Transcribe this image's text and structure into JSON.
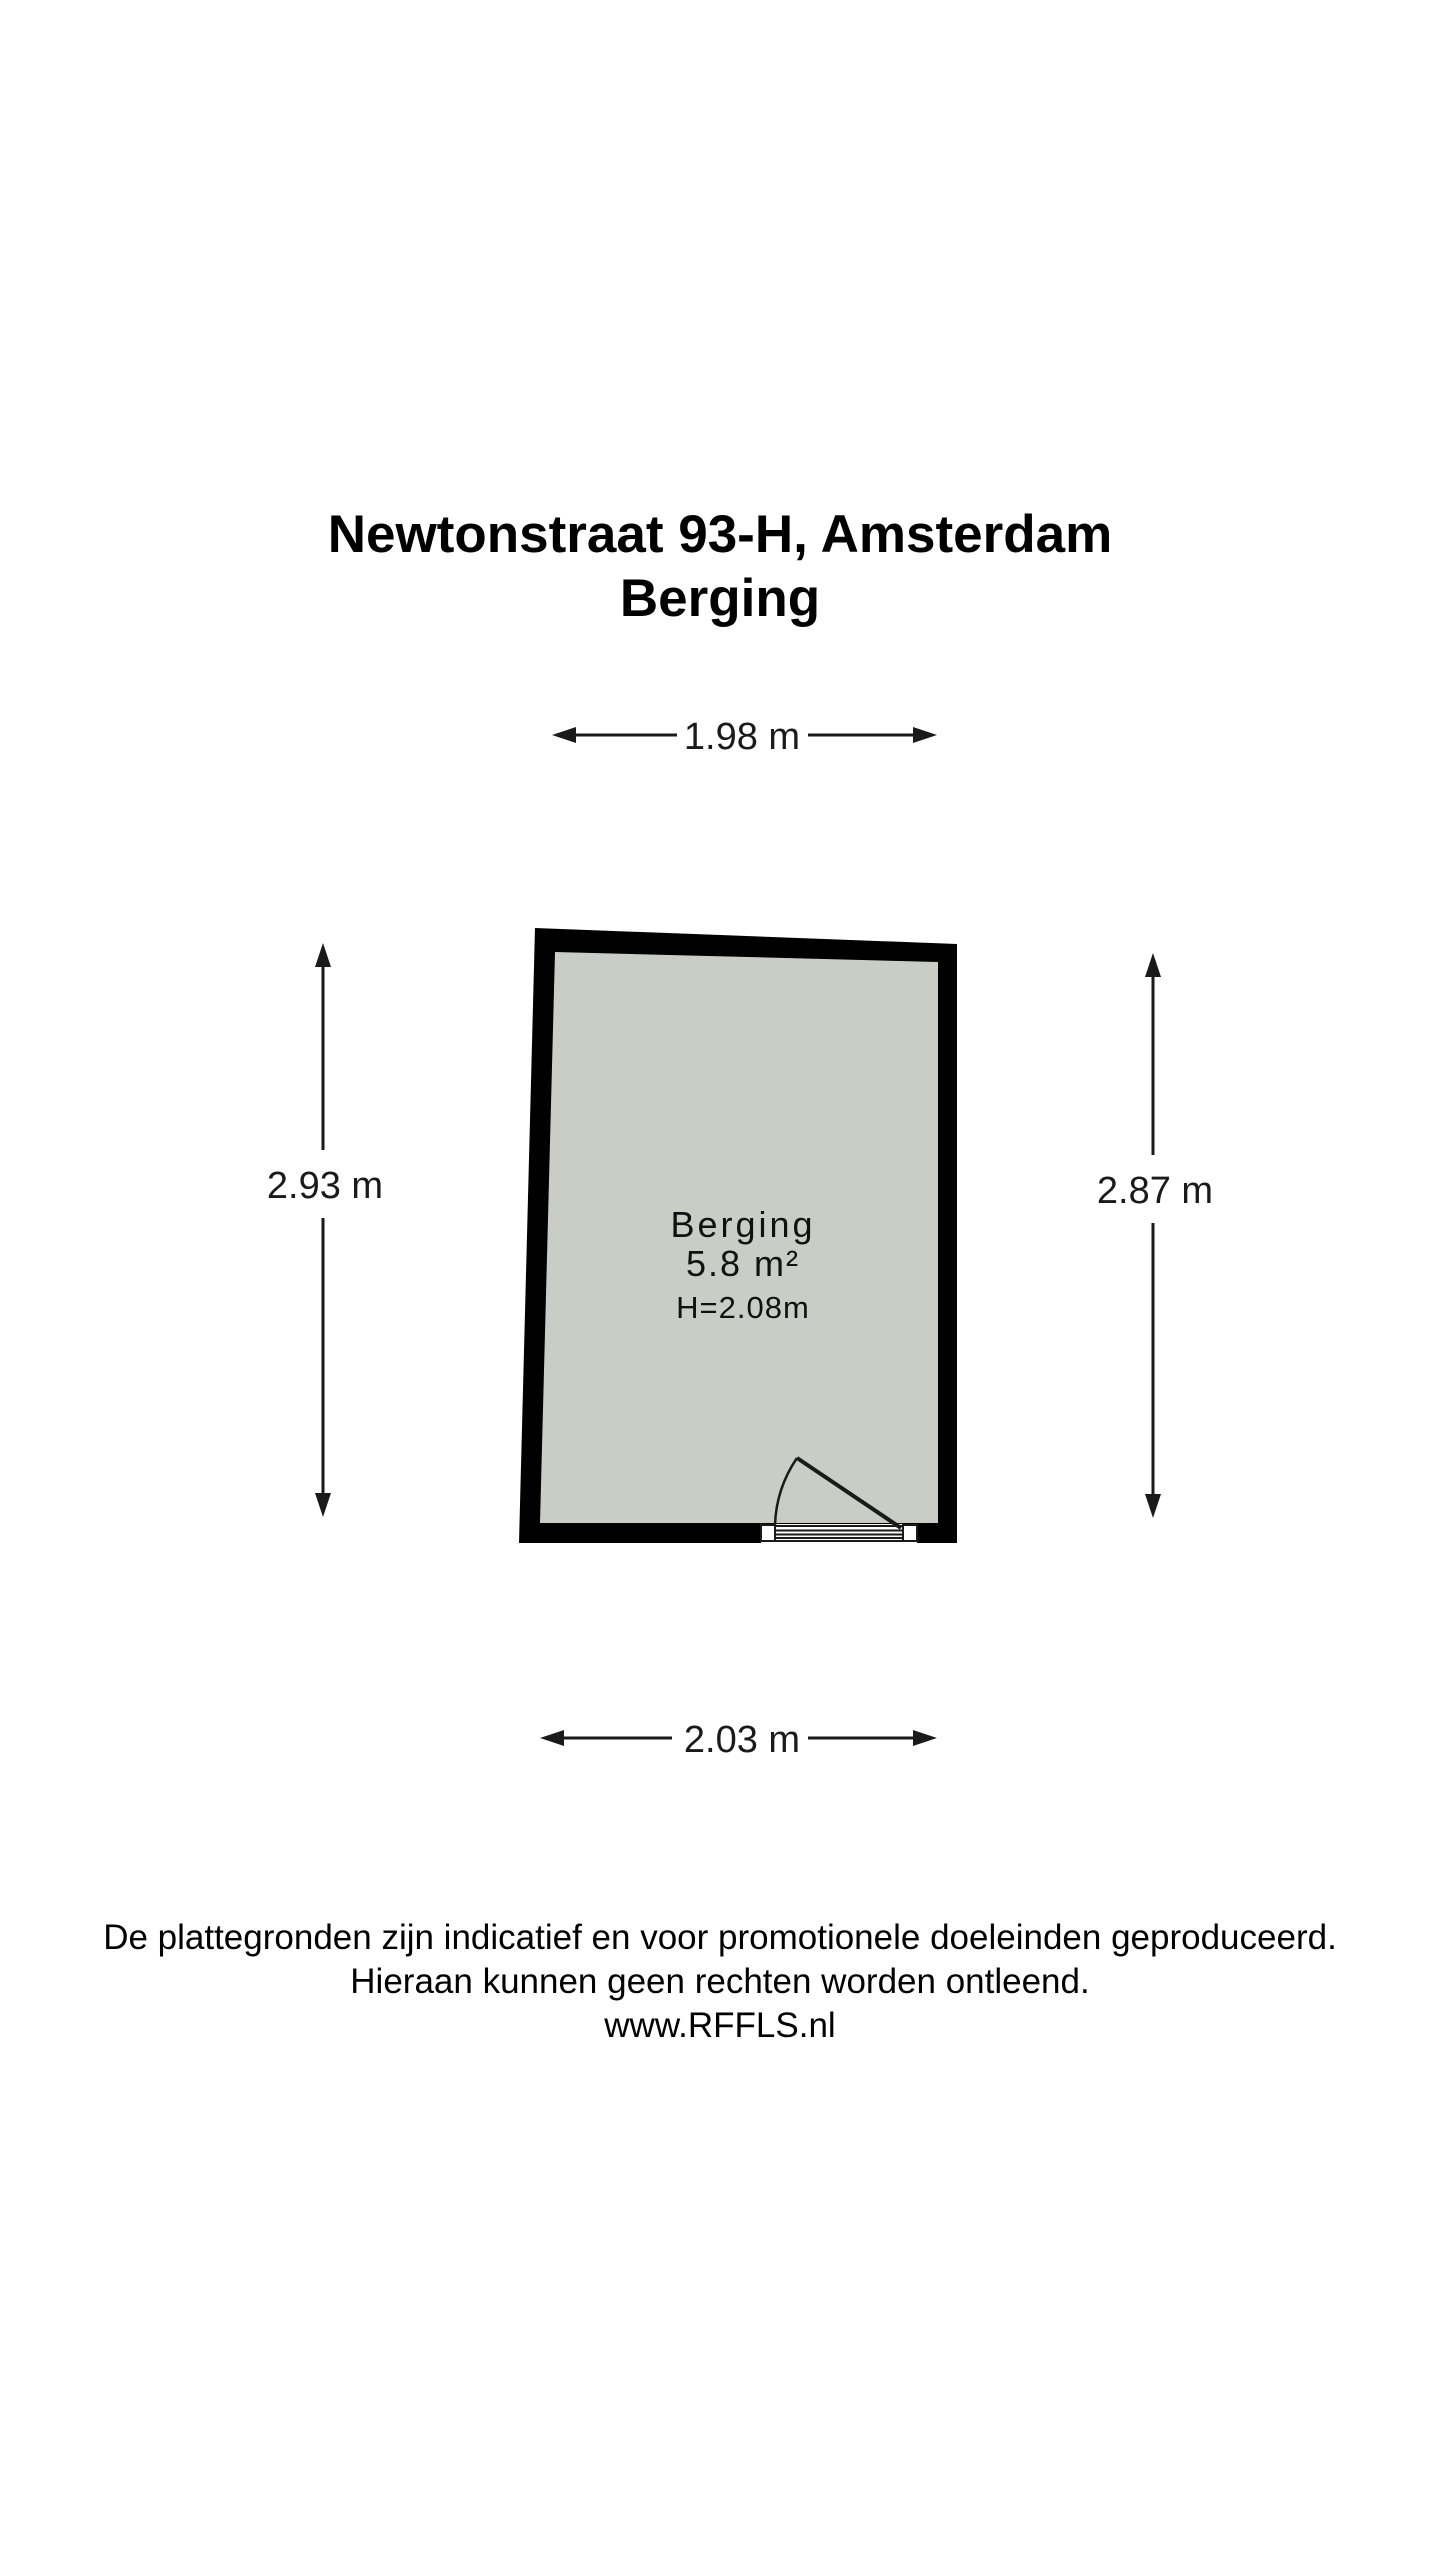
{
  "title": {
    "line1": "Newtonstraat 93-H, Amsterdam",
    "line2": "Berging"
  },
  "room": {
    "name": "Berging",
    "area": "5.8 m²",
    "ceiling_height": "H=2.08m"
  },
  "dimensions": {
    "top": "1.98 m",
    "bottom": "2.03 m",
    "left": "2.93 m",
    "right": "2.87 m"
  },
  "footer": {
    "line1": "De plattegronden zijn indicatief en voor promotionele doeleinden geproduceerd.",
    "line2": "Hieraan kunnen geen rechten worden ontleend.",
    "line3": "www.RFFLS.nl"
  },
  "colors": {
    "wall": "#000000",
    "floor": "#cacdc6",
    "door_opening": "#ffffff",
    "text": "#000000",
    "background": "#ffffff"
  }
}
